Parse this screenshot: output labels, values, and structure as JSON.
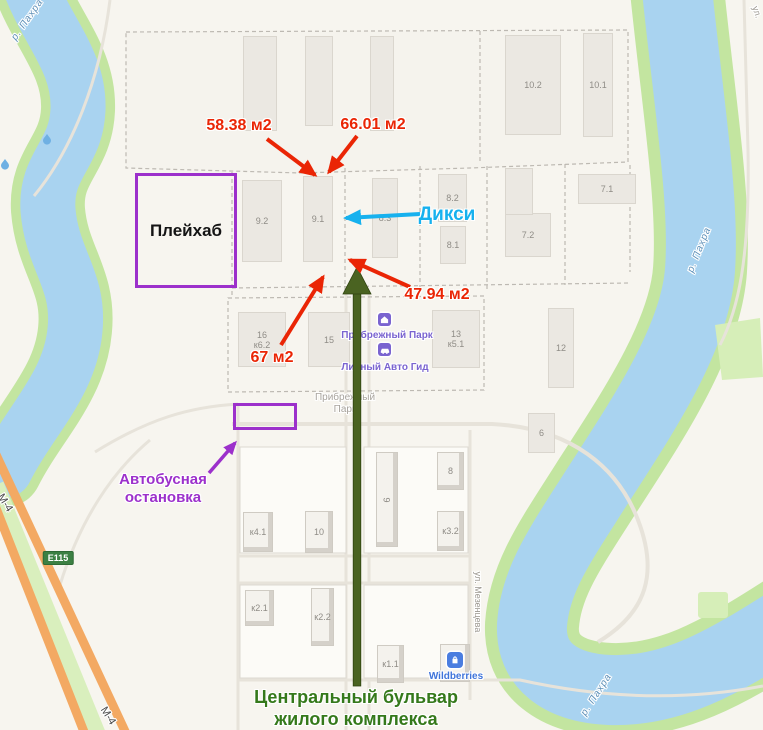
{
  "annotations": {
    "area_labels": [
      {
        "text": "58.38 м2"
      },
      {
        "text": "66.01 м2"
      },
      {
        "text": "47.94 м2"
      },
      {
        "text": "67 м2"
      }
    ],
    "diksi_label": "Дикси",
    "playhub_label": "Плейхаб",
    "bus_stop_label": "Автобусная\nостановка",
    "boulevard_caption": "Центральный бульвар\nжилого комплекса",
    "colors": {
      "red": "#ea2505",
      "cyan": "#17b1ee",
      "purple": "#9c30cb",
      "green_arrow": "#4a6321",
      "green_text": "#35791b"
    }
  },
  "map": {
    "buildings": [
      {
        "label": "10.2",
        "x": 505,
        "y": 35,
        "w": 56,
        "h": 100
      },
      {
        "label": "10.1",
        "x": 583,
        "y": 33,
        "w": 30,
        "h": 104
      },
      {
        "label": "8.2",
        "x": 438,
        "y": 174,
        "w": 29,
        "h": 48
      },
      {
        "label": "8.1",
        "x": 440,
        "y": 226,
        "w": 26,
        "h": 38
      },
      {
        "label": "7.1",
        "x": 578,
        "y": 174,
        "w": 58,
        "h": 30
      },
      {
        "label": "7.2",
        "x": 505,
        "y": 213,
        "w": 46,
        "h": 44
      },
      {
        "label": "9.2",
        "x": 242,
        "y": 180,
        "w": 40,
        "h": 82
      },
      {
        "label": "9.1",
        "x": 303,
        "y": 176,
        "w": 30,
        "h": 86
      },
      {
        "label": "8.3",
        "x": 372,
        "y": 178,
        "w": 26,
        "h": 80
      },
      {
        "label": "16\nк6.2",
        "x": 238,
        "y": 312,
        "w": 48,
        "h": 55
      },
      {
        "label": "15",
        "x": 308,
        "y": 312,
        "w": 42,
        "h": 55
      },
      {
        "label": "13\nк5.1",
        "x": 432,
        "y": 310,
        "w": 48,
        "h": 58
      },
      {
        "label": "12",
        "x": 548,
        "y": 308,
        "w": 26,
        "h": 80
      },
      {
        "label": "6",
        "x": 528,
        "y": 413,
        "w": 27,
        "h": 40
      },
      {
        "label": "8",
        "x": 437,
        "y": 452,
        "w": 27,
        "h": 38,
        "s": "b"
      },
      {
        "label": "9",
        "x": 376,
        "y": 452,
        "w": 22,
        "h": 95,
        "s": "b",
        "rot": 1
      },
      {
        "label": "к3.2",
        "x": 437,
        "y": 511,
        "w": 27,
        "h": 40,
        "s": "b"
      },
      {
        "label": "к4.1",
        "x": 243,
        "y": 512,
        "w": 30,
        "h": 40,
        "s": "b"
      },
      {
        "label": "10",
        "x": 305,
        "y": 511,
        "w": 28,
        "h": 42,
        "s": "b"
      },
      {
        "label": "к2.1",
        "x": 245,
        "y": 590,
        "w": 29,
        "h": 36,
        "s": "b"
      },
      {
        "label": "к2.2",
        "x": 311,
        "y": 588,
        "w": 23,
        "h": 58,
        "s": "b"
      },
      {
        "label": "к1.1",
        "x": 377,
        "y": 645,
        "w": 27,
        "h": 38,
        "s": "b"
      },
      {
        "label": "",
        "x": 440,
        "y": 644,
        "w": 30,
        "h": 38,
        "s": "b"
      },
      {
        "label": "",
        "x": 243,
        "y": 36,
        "w": 34,
        "h": 95
      },
      {
        "label": "",
        "x": 305,
        "y": 36,
        "w": 28,
        "h": 90
      },
      {
        "label": "",
        "x": 370,
        "y": 36,
        "w": 24,
        "h": 95
      },
      {
        "label": "",
        "x": 505,
        "y": 168,
        "w": 28,
        "h": 47
      }
    ],
    "labels": [
      {
        "name": "poi-label-pribrezhny-park",
        "text": "Прибрежный Парк",
        "x": 387,
        "y": 336,
        "cls": "poi-purple"
      },
      {
        "name": "poi-label-lichny-avto-gid",
        "text": "Личный Авто Гид",
        "x": 385,
        "y": 368,
        "cls": "poi-purple"
      },
      {
        "name": "area-label-pribrezhny-park",
        "text": "Прибрежный\nПарк",
        "x": 345,
        "y": 404,
        "cls": "poi-gray"
      },
      {
        "name": "poi-label-wildberries",
        "text": "Wildberries",
        "x": 456,
        "y": 677,
        "cls": "poi-blue"
      },
      {
        "name": "street-label-mezentseva",
        "text": "ул. Мезенцева",
        "x": 478,
        "y": 602,
        "cls": "street",
        "rot": 90
      },
      {
        "name": "street-label-corner",
        "text": "ул.",
        "x": 757,
        "y": 12,
        "cls": "street",
        "rot": 72
      },
      {
        "name": "river-label-top-left",
        "text": "р. Пахра",
        "x": 28,
        "y": 20,
        "cls": "river",
        "rot": -55
      },
      {
        "name": "river-label-right",
        "text": "р. Пахра",
        "x": 700,
        "y": 250,
        "cls": "river",
        "rot": -68
      },
      {
        "name": "river-label-bottom",
        "text": "р. Пахра",
        "x": 597,
        "y": 695,
        "cls": "river",
        "rot": -57
      },
      {
        "name": "highway-label-m4-top",
        "text": "М-4",
        "x": 5,
        "y": 503,
        "cls": "hwy",
        "rot": 58
      },
      {
        "name": "highway-label-m4-bottom",
        "text": "М-4",
        "x": 108,
        "y": 716,
        "cls": "hwy",
        "rot": 58
      },
      {
        "name": "road-badge-e115",
        "text": "E115",
        "x": 58,
        "y": 558,
        "cls": "badge"
      }
    ]
  }
}
